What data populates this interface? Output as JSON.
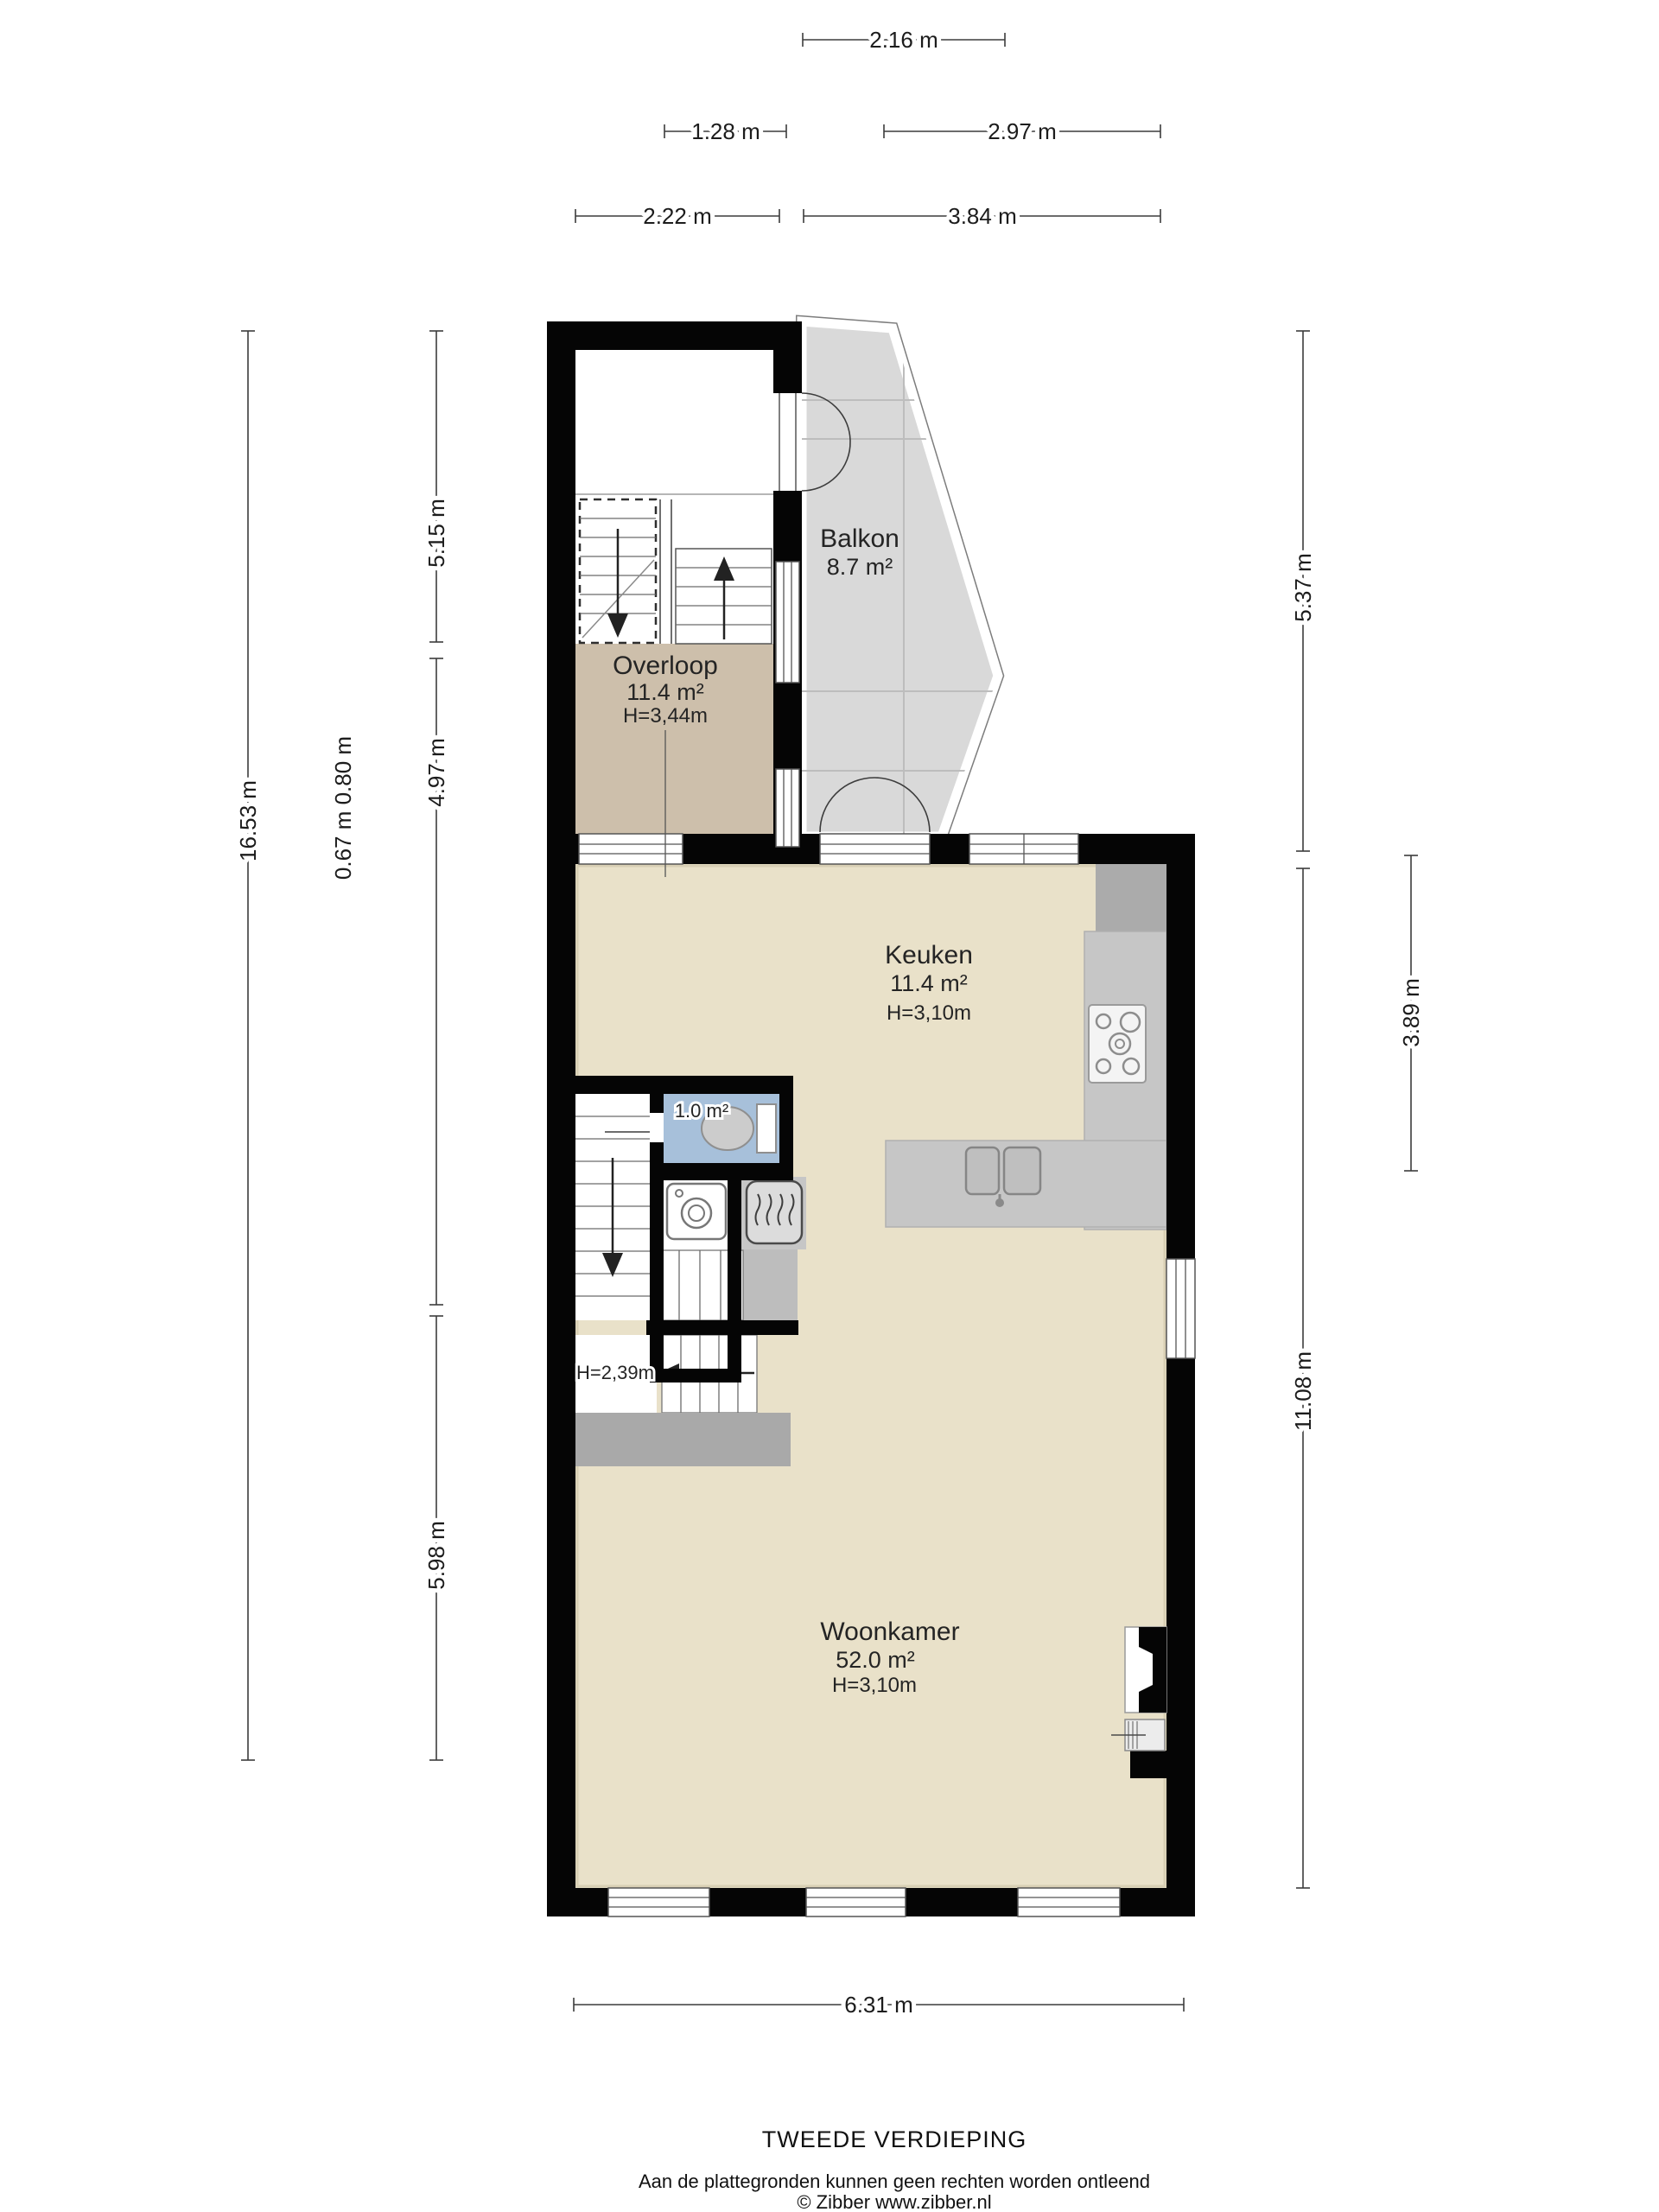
{
  "floor": {
    "title": "TWEEDE VERDIEPING",
    "disclaimer": "Aan de plattegronden kunnen geen rechten worden ontleend",
    "credit": "© Zibber www.zibber.nl"
  },
  "rooms": {
    "balkon": {
      "name": "Balkon",
      "area": "8.7 m²"
    },
    "overloop": {
      "name": "Overloop",
      "area": "11.4 m²",
      "height": "H=3,44m"
    },
    "keuken": {
      "name": "Keuken",
      "area": "11.4 m²",
      "height": "H=3,10m"
    },
    "toilet": {
      "area": "1.0 m²"
    },
    "woonkamer": {
      "name": "Woonkamer",
      "area": "52.0 m²",
      "height": "H=3,10m"
    },
    "trap": {
      "height": "H=2,39m"
    }
  },
  "dimensions": {
    "top": [
      {
        "label": "2.16 m"
      },
      {
        "label": "1.28 m"
      },
      {
        "label": "2.97 m"
      },
      {
        "label": "2.22 m"
      },
      {
        "label": "3.84 m"
      }
    ],
    "left": [
      {
        "label": "16.53 m"
      },
      {
        "label": "5.15 m"
      },
      {
        "label": "4.97 m"
      },
      {
        "label": "5.98 m"
      },
      {
        "label": "0.67 m 0.80 m"
      }
    ],
    "right": [
      {
        "label": "5.37 m"
      },
      {
        "label": "11.08 m"
      },
      {
        "label": "3.89 m"
      }
    ],
    "bottom": [
      {
        "label": "6.31 m"
      }
    ]
  },
  "colors": {
    "wall": "#050505",
    "floor_main": "#e9e1c9",
    "floor_overloop": "#cdbfab",
    "floor_balkon": "#d9d9d9",
    "floor_toilet": "#a7c0da",
    "counter_gray": "#c6c6c6",
    "lowered_ceiling_gray": "#a9a9a9"
  }
}
